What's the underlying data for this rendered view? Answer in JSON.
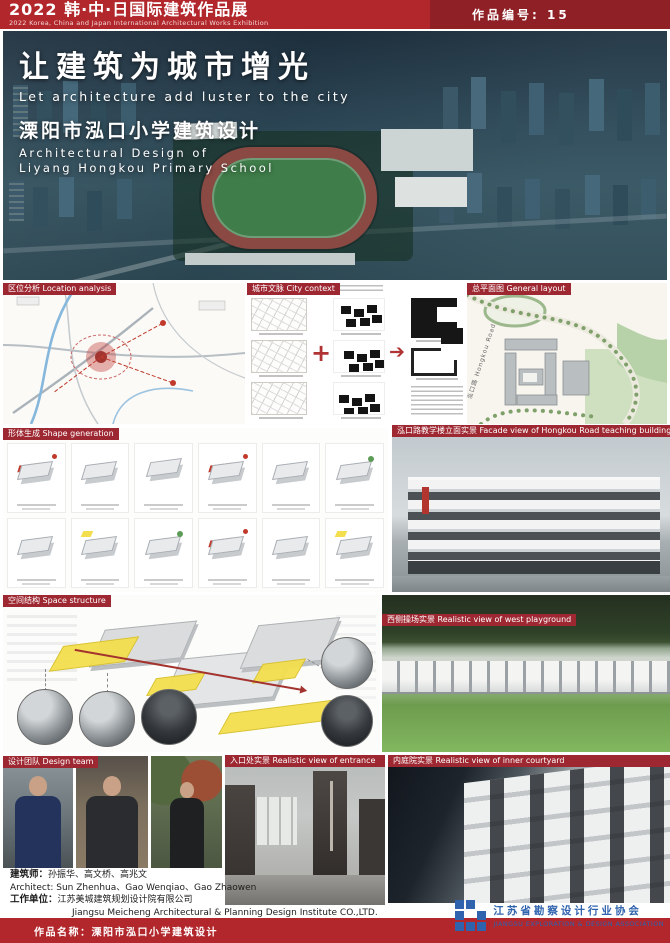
{
  "header": {
    "title": "2022 韩·中·日国际建筑作品展",
    "subtitle": "2022 Korea, China and Japan International Architectural Works Exhibition",
    "work_number": "作品编号: 15"
  },
  "hero": {
    "title_cn": "让建筑为城市增光",
    "title_en": "Let architecture add luster to the city",
    "project_cn": "溧阳市泓口小学建筑设计",
    "project_en_line1": "Architectural Design of",
    "project_en_line2": "Liyang Hongkou Primary School"
  },
  "sections": {
    "location_label": "区位分析 Location analysis",
    "context_label": "城市文脉 City context",
    "layout_label": "总平面图 General layout",
    "shape_label": "形体生成 Shape generation",
    "facade_label": "泓口路教学楼立面实景 Facade view of Hongkou Road teaching building",
    "space_label": "空间结构 Space structure",
    "playground_label": "西侧操场实景 Realistic view of west playground",
    "team_label": "设计团队 Design team",
    "entrance_label": "入口处实景 Realistic view of entrance",
    "courtyard_label": "内庭院实景 Realistic view of inner courtyard"
  },
  "context_flow": {
    "plus": "+",
    "arrow": "➔"
  },
  "site_plan": {
    "road_label": "泓口路 Hongkou Road"
  },
  "credits": {
    "architect_label": "建筑师：",
    "architect_names": "孙振华、高文桥、高兆文",
    "architect_en": "Architect: Sun Zhenhua、Gao Wenqiao、Gao Zhaowen",
    "company_label": "工作单位：",
    "company_name": "江苏美城建筑规划设计院有限公司",
    "company_en": "Jiangsu Meicheng Architectural & Planning Design Institute CO.,LTD."
  },
  "association": {
    "name_cn": "江苏省勘察设计行业协会",
    "name_en": "JIANGSU EXPLORATION & DESIGN ASSOCIATION"
  },
  "footer": {
    "work_name": "作品名称：溧阳市泓口小学建筑设计"
  },
  "colors": {
    "header_red": "#b2272c",
    "badge_red": "#8e2026",
    "label_red": "#9e2832",
    "accent_red": "#c0392b",
    "highlight_yellow": "#f3df4e",
    "logo_blue": "#2f63ae"
  }
}
